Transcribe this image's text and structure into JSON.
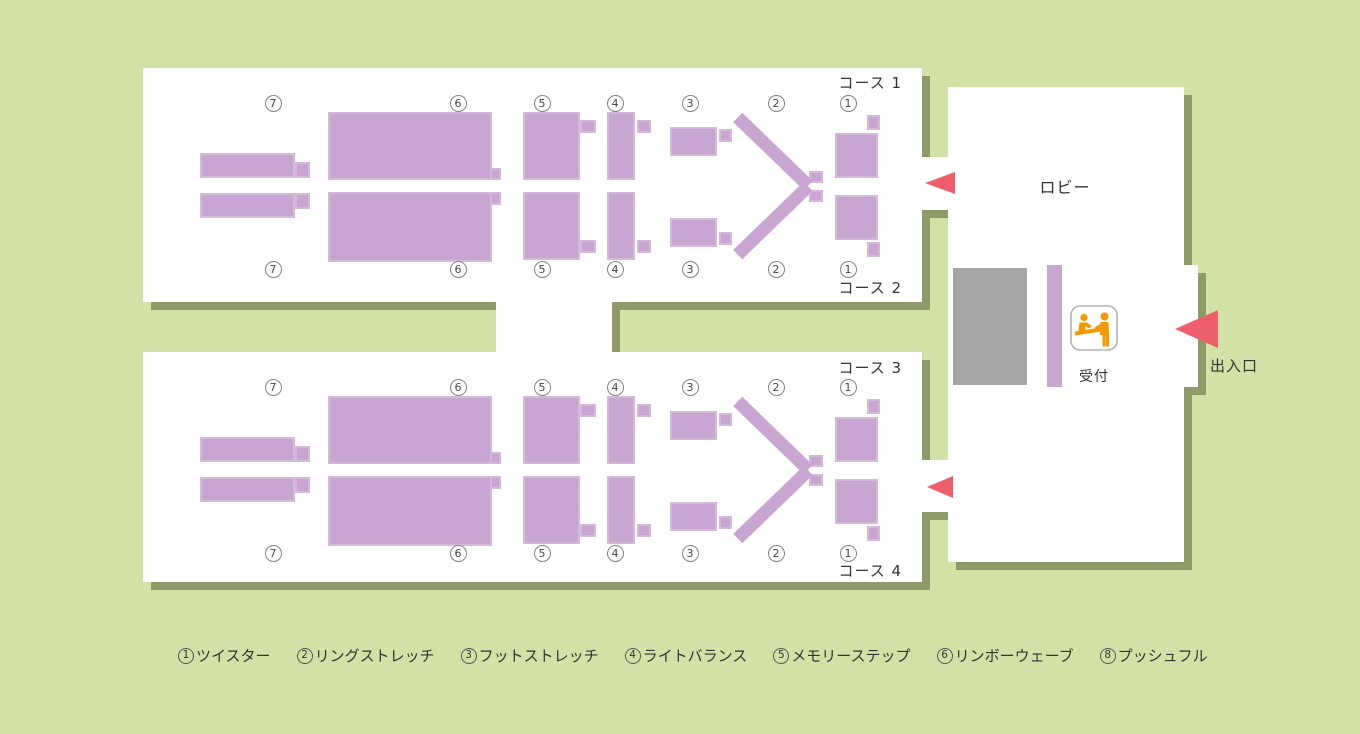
{
  "labels": {
    "lobby": "ロビー",
    "reception": "受付",
    "entrance": "出入口"
  },
  "courses": [
    "コース 1",
    "コース 2",
    "コース 3",
    "コース 4"
  ],
  "station_numbers": [
    "7",
    "6",
    "5",
    "4",
    "3",
    "2",
    "1"
  ],
  "legend": [
    {
      "number": "1",
      "name": "ツイスター"
    },
    {
      "number": "2",
      "name": "リングストレッチ"
    },
    {
      "number": "3",
      "name": "フットストレッチ"
    },
    {
      "number": "4",
      "name": "ライトバランス"
    },
    {
      "number": "5",
      "name": "メモリーステップ"
    },
    {
      "number": "6",
      "name": "リンボーウェーブ"
    },
    {
      "number": "8",
      "name": "プッシュフル"
    }
  ],
  "colors": {
    "background": "#d2e2a7",
    "wall_shadow": "#8e9b68",
    "room": "#ffffff",
    "equipment": "#c9a5d2",
    "arrow": "#ef5f6b",
    "desk": "#a5a5a5",
    "icon_orange": "#f39800"
  }
}
